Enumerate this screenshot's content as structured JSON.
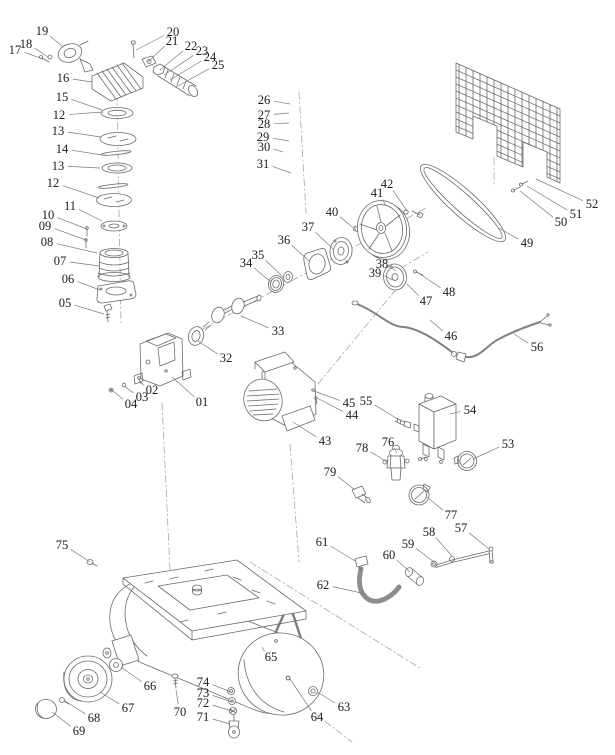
{
  "diagram": {
    "kind": "exploded-parts-diagram",
    "subject": "belt-driven air compressor parts schematic",
    "background_color": "#ffffff",
    "line_color": "#6a6a6a",
    "label_color": "#1b1b1b",
    "part_labels": [
      {
        "text": "01",
        "tx": 202,
        "ty": 402,
        "px": 172,
        "py": 377
      },
      {
        "text": "02",
        "tx": 152,
        "ty": 390,
        "px": 141,
        "py": 382
      },
      {
        "text": "03",
        "tx": 142,
        "ty": 397,
        "px": 124,
        "py": 386
      },
      {
        "text": "04",
        "tx": 131,
        "ty": 404,
        "px": 112,
        "py": 390
      },
      {
        "text": "05",
        "tx": 65,
        "ty": 303,
        "px": 104,
        "py": 314
      },
      {
        "text": "06",
        "tx": 68,
        "ty": 279,
        "px": 100,
        "py": 290
      },
      {
        "text": "07",
        "tx": 60,
        "ty": 261,
        "px": 99,
        "py": 266
      },
      {
        "text": "08",
        "tx": 47,
        "ty": 242,
        "px": 97,
        "py": 253
      },
      {
        "text": "09",
        "tx": 45,
        "ty": 226,
        "px": 86,
        "py": 240
      },
      {
        "text": "10",
        "tx": 48,
        "ty": 215,
        "px": 87,
        "py": 229
      },
      {
        "text": "11",
        "tx": 70,
        "ty": 206,
        "px": 102,
        "py": 221
      },
      {
        "text": "12",
        "tx": 59,
        "ty": 115,
        "px": 103,
        "py": 112
      },
      {
        "text": "13",
        "tx": 58,
        "ty": 131,
        "px": 101,
        "py": 137
      },
      {
        "text": "14",
        "tx": 62,
        "ty": 149,
        "px": 102,
        "py": 155
      },
      {
        "text": "13",
        "tx": 58,
        "ty": 166,
        "px": 100,
        "py": 168
      },
      {
        "text": "12",
        "tx": 53,
        "ty": 183,
        "px": 99,
        "py": 198
      },
      {
        "text": "15",
        "tx": 62,
        "ty": 97,
        "px": 102,
        "py": 110
      },
      {
        "text": "16",
        "tx": 63,
        "ty": 78,
        "px": 92,
        "py": 82
      },
      {
        "text": "17",
        "tx": 15,
        "ty": 50,
        "px": 43,
        "py": 59
      },
      {
        "text": "18",
        "tx": 26,
        "ty": 44,
        "px": 48,
        "py": 57
      },
      {
        "text": "19",
        "tx": 42,
        "ty": 31,
        "px": 63,
        "py": 47
      },
      {
        "text": "20",
        "tx": 173,
        "ty": 32,
        "px": 136,
        "py": 50
      },
      {
        "text": "21",
        "tx": 172,
        "ty": 41,
        "px": 148,
        "py": 62
      },
      {
        "text": "22",
        "tx": 191,
        "ty": 46,
        "px": 160,
        "py": 70
      },
      {
        "text": "23",
        "tx": 202,
        "ty": 51,
        "px": 164,
        "py": 75
      },
      {
        "text": "24",
        "tx": 210,
        "ty": 57,
        "px": 170,
        "py": 80
      },
      {
        "text": "25",
        "tx": 218,
        "ty": 65,
        "px": 176,
        "py": 87
      },
      {
        "text": "26",
        "tx": 264,
        "ty": 100,
        "px": 290,
        "py": 104
      },
      {
        "text": "27",
        "tx": 264,
        "ty": 115,
        "px": 289,
        "py": 113
      },
      {
        "text": "28",
        "tx": 264,
        "ty": 124,
        "px": 289,
        "py": 123
      },
      {
        "text": "29",
        "tx": 263,
        "ty": 137,
        "px": 289,
        "py": 141
      },
      {
        "text": "30",
        "tx": 264,
        "ty": 147,
        "px": 283,
        "py": 152
      },
      {
        "text": "31",
        "tx": 263,
        "ty": 164,
        "px": 291,
        "py": 173
      },
      {
        "text": "32",
        "tx": 226,
        "ty": 358,
        "px": 198,
        "py": 341
      },
      {
        "text": "33",
        "tx": 278,
        "ty": 331,
        "px": 241,
        "py": 316
      },
      {
        "text": "34",
        "tx": 246,
        "ty": 263,
        "px": 271,
        "py": 282
      },
      {
        "text": "35",
        "tx": 258,
        "ty": 255,
        "px": 284,
        "py": 278
      },
      {
        "text": "36",
        "tx": 284,
        "ty": 240,
        "px": 309,
        "py": 261
      },
      {
        "text": "37",
        "tx": 308,
        "ty": 227,
        "px": 333,
        "py": 249
      },
      {
        "text": "38",
        "tx": 382,
        "ty": 264,
        "px": 396,
        "py": 271
      },
      {
        "text": "39",
        "tx": 375,
        "ty": 273,
        "px": 393,
        "py": 280
      },
      {
        "text": "40",
        "tx": 332,
        "ty": 212,
        "px": 356,
        "py": 230
      },
      {
        "text": "41",
        "tx": 377,
        "ty": 193,
        "px": 386,
        "py": 206
      },
      {
        "text": "42",
        "tx": 387,
        "ty": 184,
        "px": 407,
        "py": 211
      },
      {
        "text": "43",
        "tx": 325,
        "ty": 441,
        "px": 293,
        "py": 422
      },
      {
        "text": "44",
        "tx": 352,
        "ty": 415,
        "px": 317,
        "py": 398
      },
      {
        "text": "45",
        "tx": 349,
        "ty": 403,
        "px": 314,
        "py": 391
      },
      {
        "text": "46",
        "tx": 451,
        "ty": 336,
        "px": 430,
        "py": 320
      },
      {
        "text": "47",
        "tx": 426,
        "ty": 301,
        "px": 407,
        "py": 284
      },
      {
        "text": "48",
        "tx": 449,
        "ty": 292,
        "px": 420,
        "py": 274
      },
      {
        "text": "49",
        "tx": 527,
        "ty": 243,
        "px": 499,
        "py": 228
      },
      {
        "text": "50",
        "tx": 561,
        "ty": 222,
        "px": 520,
        "py": 191
      },
      {
        "text": "51",
        "tx": 576,
        "ty": 214,
        "px": 527,
        "py": 186
      },
      {
        "text": "52",
        "tx": 592,
        "ty": 204,
        "px": 536,
        "py": 179
      },
      {
        "text": "53",
        "tx": 508,
        "ty": 444,
        "px": 473,
        "py": 459
      },
      {
        "text": "54",
        "tx": 470,
        "ty": 410,
        "px": 450,
        "py": 414
      },
      {
        "text": "55",
        "tx": 366,
        "ty": 401,
        "px": 396,
        "py": 418
      },
      {
        "text": "56",
        "tx": 537,
        "ty": 347,
        "px": 514,
        "py": 334
      },
      {
        "text": "57",
        "tx": 461,
        "ty": 528,
        "px": 489,
        "py": 549
      },
      {
        "text": "58",
        "tx": 429,
        "ty": 532,
        "px": 452,
        "py": 556
      },
      {
        "text": "59",
        "tx": 408,
        "ty": 544,
        "px": 434,
        "py": 562
      },
      {
        "text": "60",
        "tx": 389,
        "ty": 555,
        "px": 410,
        "py": 572
      },
      {
        "text": "61",
        "tx": 322,
        "ty": 542,
        "px": 355,
        "py": 561
      },
      {
        "text": "62",
        "tx": 323,
        "ty": 585,
        "px": 366,
        "py": 594
      },
      {
        "text": "63",
        "tx": 344,
        "ty": 707,
        "px": 317,
        "py": 692
      },
      {
        "text": "64",
        "tx": 317,
        "ty": 717,
        "px": 290,
        "py": 679
      },
      {
        "text": "65",
        "tx": 271,
        "ty": 657,
        "px": 262,
        "py": 647
      },
      {
        "text": "66",
        "tx": 150,
        "ty": 686,
        "px": 121,
        "py": 667
      },
      {
        "text": "67",
        "tx": 128,
        "ty": 708,
        "px": 100,
        "py": 692
      },
      {
        "text": "68",
        "tx": 94,
        "ty": 718,
        "px": 65,
        "py": 701
      },
      {
        "text": "69",
        "tx": 79,
        "ty": 731,
        "px": 52,
        "py": 712
      },
      {
        "text": "70",
        "tx": 180,
        "ty": 712,
        "px": 176,
        "py": 690
      },
      {
        "text": "71",
        "tx": 203,
        "ty": 717,
        "px": 230,
        "py": 724
      },
      {
        "text": "72",
        "tx": 203,
        "ty": 703,
        "px": 232,
        "py": 711
      },
      {
        "text": "73",
        "tx": 203,
        "ty": 693,
        "px": 232,
        "py": 702
      },
      {
        "text": "74",
        "tx": 203,
        "ty": 682,
        "px": 231,
        "py": 692
      },
      {
        "text": "75",
        "tx": 62,
        "ty": 545,
        "px": 90,
        "py": 562
      },
      {
        "text": "76",
        "tx": 388,
        "ty": 442,
        "px": 397,
        "py": 453
      },
      {
        "text": "77",
        "tx": 451,
        "ty": 515,
        "px": 427,
        "py": 497
      },
      {
        "text": "78",
        "tx": 362,
        "ty": 448,
        "px": 387,
        "py": 462
      },
      {
        "text": "79",
        "tx": 330,
        "ty": 472,
        "px": 355,
        "py": 490
      }
    ]
  }
}
